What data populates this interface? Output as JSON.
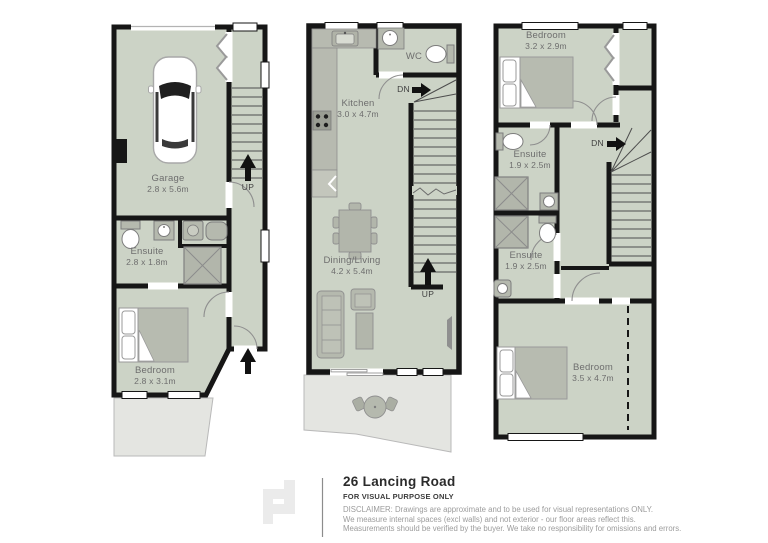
{
  "floors": [
    {
      "id": "ground-floor",
      "rooms": [
        {
          "name": "Garage",
          "dims": "2.8 x 5.6m"
        },
        {
          "name": "Ensuite",
          "dims": "2.8 x 1.8m"
        },
        {
          "name": "Bedroom",
          "dims": "2.8 x 3.1m"
        }
      ],
      "stairs": [
        {
          "label": "UP"
        }
      ]
    },
    {
      "id": "first-floor",
      "rooms": [
        {
          "name": "Kitchen",
          "dims": "3.0 x 4.7m"
        },
        {
          "name": "WC",
          "dims": ""
        },
        {
          "name": "Dining/Living",
          "dims": "4.2 x 5.4m"
        }
      ],
      "stairs": [
        {
          "label": "DN"
        },
        {
          "label": "UP"
        }
      ]
    },
    {
      "id": "second-floor",
      "rooms": [
        {
          "name": "Bedroom",
          "dims": "3.2 x 2.9m"
        },
        {
          "name": "Ensuite",
          "dims": "1.9 x 2.5m"
        },
        {
          "name": "Ensuite",
          "dims": "1.9 x 2.5m"
        },
        {
          "name": "Bedroom",
          "dims": "3.5 x 4.7m"
        }
      ],
      "stairs": [
        {
          "label": "DN"
        }
      ]
    }
  ],
  "footer": {
    "title": "26 Lancing Road",
    "purpose": "FOR VISUAL PURPOSE ONLY",
    "disclaimer": [
      "DISCLAIMER:  Drawings are approximate and to be used for visual representations ONLY.",
      "We measure internal spaces (excl walls) and not exterior - our floor areas reflect this.",
      "Measurements should be verified by the buyer. We take no responsibility for omissions and errors."
    ]
  },
  "colors": {
    "floor": "#ccd3c6",
    "wall": "#161616",
    "furniture": "#b5b9ae",
    "patio": "#e4e5e1",
    "label_text": "#6e6e6e",
    "disclaimer_text": "#9c9c9c"
  }
}
